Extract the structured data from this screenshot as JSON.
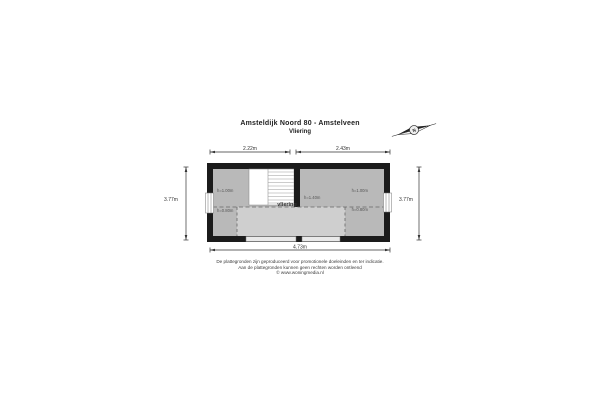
{
  "header": {
    "title": "Amsteldijk Noord 80 - Amstelveen",
    "subtitle": "Vliering"
  },
  "compass": {
    "north_label": "N"
  },
  "dimensions": {
    "top_left": "2.22m",
    "top_right": "2.43m",
    "side_left": "3.77m",
    "side_right": "3.77m",
    "bottom": "4.73m"
  },
  "floorplan": {
    "room_label": "vliering",
    "height_labels": {
      "top_left": "h=1.00m",
      "top_right": "h=1.00m",
      "bottom_left": "h=0.80m",
      "bottom_right": "h=0.80m",
      "center": "h=1.40m"
    },
    "colors": {
      "wall": "#1b1b1b",
      "floor": "#b9b9b9",
      "floor_light": "#cfcfcf",
      "stairs": "#ffffff"
    }
  },
  "footer": {
    "line1": "De plattegronden zijn geproduceerd voor promotionele doeleinden en ter indicatie.",
    "line2": "Aan de plattegronden kunnen geen rechten worden ontleend",
    "line3": "© www.woningmedia.nl"
  }
}
